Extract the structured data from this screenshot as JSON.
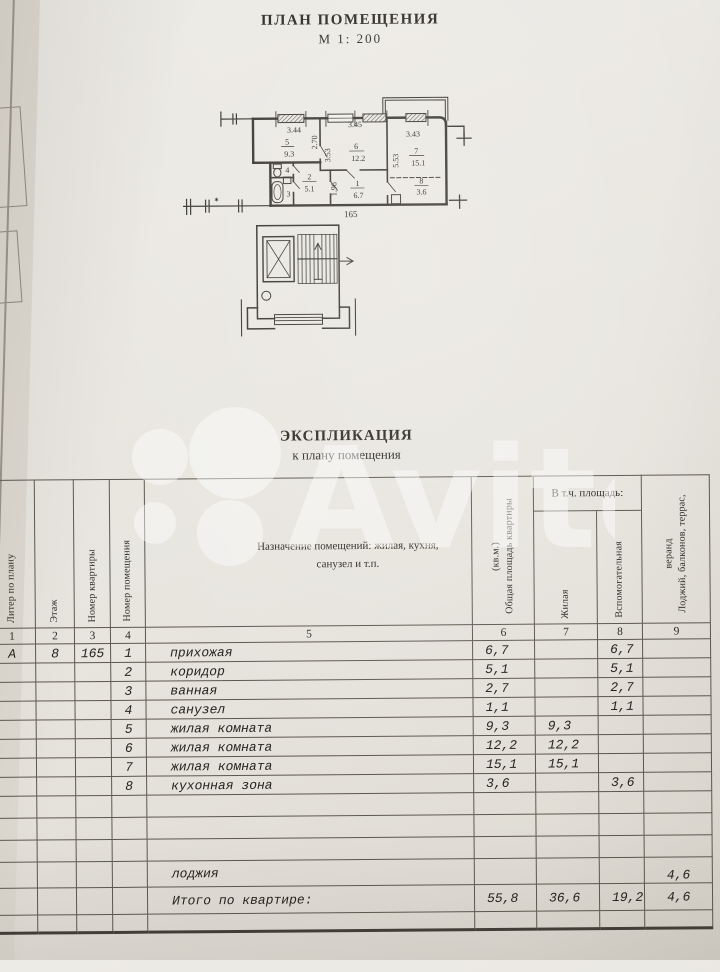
{
  "photo": {
    "watermark_text": "Avito"
  },
  "header": {
    "title": "ПЛАН ПОМЕЩЕНИЯ",
    "scale": "М 1: 200"
  },
  "plan": {
    "apartment_number": "165",
    "star_mark": "✶",
    "rooms": {
      "r1": {
        "num": "1",
        "area": "6.7"
      },
      "r2": {
        "num": "2",
        "area": "5.1"
      },
      "r3": {
        "num": "3"
      },
      "r4": {
        "num": "4"
      },
      "r5": {
        "num": "5",
        "area": "9.3"
      },
      "r6": {
        "num": "6",
        "area": "12.2"
      },
      "r7": {
        "num": "7",
        "area": "15.1"
      },
      "r8": {
        "num": "8",
        "area": "3.6"
      }
    },
    "dims": {
      "w5": "3.44",
      "h5": "2.70",
      "w6": "3.45",
      "h6": "3.53",
      "w7": "3.43",
      "h7": "5.53",
      "h1": "1.96"
    }
  },
  "explication": {
    "title": "ЭКСПЛИКАЦИЯ",
    "subtitle": "к плану помещения",
    "columns": {
      "liter": "Литер по плану",
      "floor": "Этаж",
      "flat": "Номер квартиры",
      "room": "Номер помещения",
      "purpose": "Назначение помещений: жилая, кухня, санузел и т.п.",
      "total_area": "Общая площадь квартиры (кв.м.)",
      "including": "В т.ч. площадь:",
      "living": "Жилая",
      "auxiliary": "Вспомогательная",
      "loggia": "Лоджий, балконов, террас, веранд"
    },
    "column_numbers": [
      "1",
      "2",
      "3",
      "4",
      "5",
      "6",
      "7",
      "8",
      "9"
    ],
    "first_row_meta": {
      "liter": "А",
      "floor": "8",
      "flat": "165"
    },
    "rows": [
      {
        "n": "1",
        "name": "прихожая",
        "total": "6,7",
        "living": "",
        "aux": "6,7",
        "log": ""
      },
      {
        "n": "2",
        "name": "коридор",
        "total": "5,1",
        "living": "",
        "aux": "5,1",
        "log": ""
      },
      {
        "n": "3",
        "name": "ванная",
        "total": "2,7",
        "living": "",
        "aux": "2,7",
        "log": ""
      },
      {
        "n": "4",
        "name": "санузел",
        "total": "1,1",
        "living": "",
        "aux": "1,1",
        "log": ""
      },
      {
        "n": "5",
        "name": "жилая комната",
        "total": "9,3",
        "living": "9,3",
        "aux": "",
        "log": ""
      },
      {
        "n": "6",
        "name": "жилая комната",
        "total": "12,2",
        "living": "12,2",
        "aux": "",
        "log": ""
      },
      {
        "n": "7",
        "name": "жилая комната",
        "total": "15,1",
        "living": "15,1",
        "aux": "",
        "log": ""
      },
      {
        "n": "8",
        "name": "кухонная зона",
        "total": "3,6",
        "living": "",
        "aux": "3,6",
        "log": ""
      }
    ],
    "loggia_row": {
      "name": "лоджия",
      "log": "4,6"
    },
    "total_row": {
      "name": "Итого по квартире:",
      "total": "55,8",
      "living": "36,6",
      "aux": "19,2",
      "log": "4,6"
    }
  }
}
